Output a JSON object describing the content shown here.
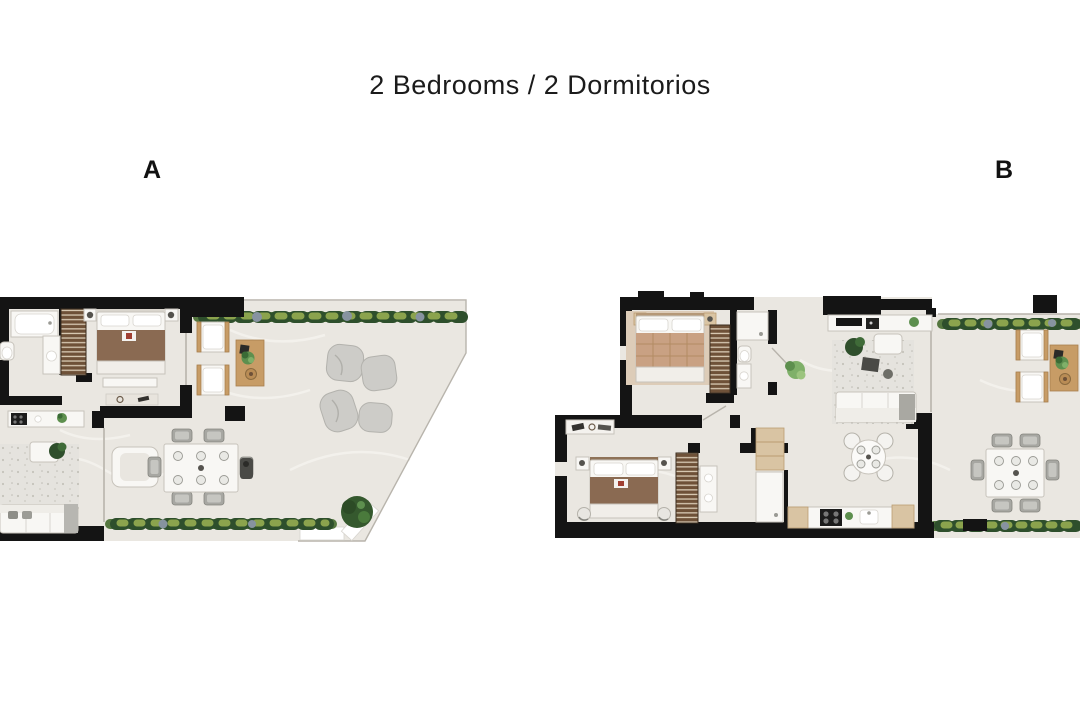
{
  "header": {
    "title": "2 Bedrooms / 2 Dormitorios"
  },
  "plans": [
    {
      "label": "A"
    },
    {
      "label": "B"
    }
  ],
  "colors": {
    "wall": "#141414",
    "floor": "#eae7e1",
    "floor_vein": "#f4f2ed",
    "outline": "#b8b4ac",
    "glass": "#c2beb6",
    "white_furn": "#f8f7f4",
    "furn_border": "#c7c3bb",
    "rug": "#e5e3de",
    "wood_dark": "#6e5138",
    "wood_stripe": "#d8cab4",
    "wood_light": "#d9c4a3",
    "wood_mid": "#c79c66",
    "bed_brown": "#8a6a52",
    "bed_tan": "#c9a183",
    "accent_red": "#a03f32",
    "hedge_dark": "#2e4f2c",
    "hedge_mid": "#55773f",
    "hedge_light": "#8ba34d",
    "hedge_stone": "#8793a0",
    "pouf": "#cdccc8",
    "tree": "#35592e",
    "plant": "#5d8f4e",
    "appliance_dark": "#1c1c1c"
  }
}
